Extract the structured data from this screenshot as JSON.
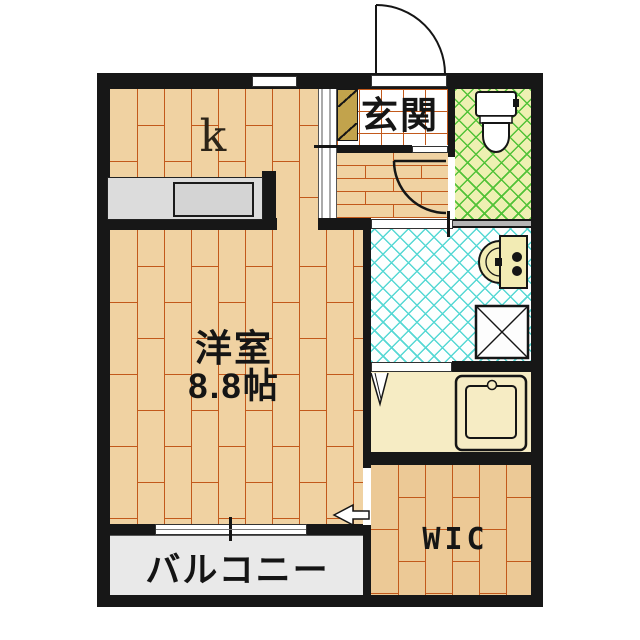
{
  "plan_type": "apartment-floorplan",
  "rooms": [
    {
      "name": "kitchen",
      "label": "k",
      "floor": "wood-plank",
      "fixtures": [
        "kitchen-counter",
        "window"
      ]
    },
    {
      "name": "entrance",
      "label": "玄関",
      "floor": "white-tile-grid",
      "fixtures": [
        "entry-door",
        "shoe-cabinet"
      ]
    },
    {
      "name": "western-room",
      "label": "洋室",
      "size": "8.8帖",
      "floor": "wood-plank",
      "fixtures": [
        "sliding-window"
      ]
    },
    {
      "name": "hallway",
      "label": "",
      "floor": "wood-plank",
      "fixtures": [
        "toilet-door-swing"
      ]
    },
    {
      "name": "toilet",
      "label": "",
      "floor": "green-crosshatch-tile",
      "fixtures": [
        "toilet"
      ]
    },
    {
      "name": "washroom",
      "label": "",
      "floor": "cyan-crosshatch-tile",
      "fixtures": [
        "washbasin",
        "washing-machine-pan"
      ]
    },
    {
      "name": "bathroom",
      "label": "",
      "floor": "cream",
      "fixtures": [
        "bathtub",
        "folding-door"
      ]
    },
    {
      "name": "walk-in-closet",
      "label": "WIC",
      "floor": "wood-plank",
      "fixtures": [
        "entry-arrow"
      ]
    },
    {
      "name": "balcony",
      "label": "バルコニー",
      "floor": "concrete-gray",
      "fixtures": []
    }
  ],
  "colors": {
    "wall": "#171717",
    "wood_floor": "#f0d2a2",
    "wood_plank_line": "#c2591b",
    "wic_floor": "#ecc996",
    "entrance_tile_line": "#c2591b",
    "toilet_floor": "#eef0b2",
    "toilet_hatch": "#52c238",
    "washroom_hatch": "#56d8d4",
    "bathroom_floor": "#f6ecc4",
    "balcony": "#e9e9e9",
    "counter": "#dcdcdc",
    "shoe_cabinet": "#c2a34c",
    "fixture_fill": "#ffffff"
  }
}
